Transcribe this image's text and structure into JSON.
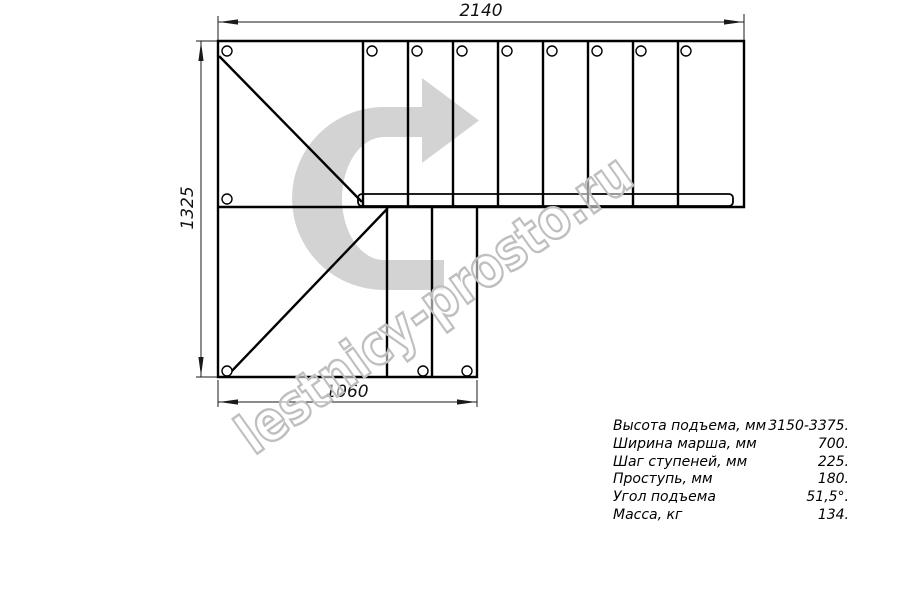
{
  "drawing": {
    "type": "staircase-plan-top-view"
  },
  "watermark": {
    "text": "lestnicy-prosto.ru"
  },
  "dimensions": {
    "top_width_mm": "2140",
    "left_height_mm": "1325",
    "bottom_width_mm": "1060"
  },
  "specs": {
    "rows": [
      {
        "label": "Высота подъема, мм",
        "value": "3150-3375."
      },
      {
        "label": "Ширина марша, мм",
        "value": "700."
      },
      {
        "label": "Шаг ступеней, мм",
        "value": "225."
      },
      {
        "label": "Проступь, мм",
        "value": "180."
      },
      {
        "label": "Угол подъема",
        "value": "51,5°."
      },
      {
        "label": "Масса, кг",
        "value": "134."
      }
    ]
  },
  "colors": {
    "line_color": "#000000",
    "dim_color": "#1a1a1a",
    "arrow_fill": "#d3d3d3",
    "watermark_stroke": "#bfbfbf",
    "background": "#ffffff"
  }
}
